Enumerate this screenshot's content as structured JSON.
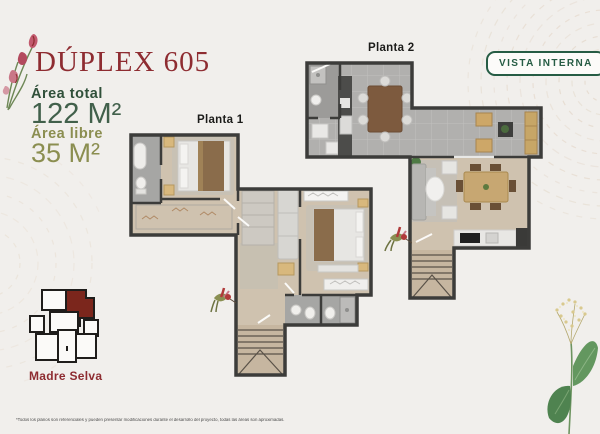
{
  "header": {
    "title": "DÚPLEX 605",
    "area_total_label": "Área total",
    "area_total_value": "122 M²",
    "area_libre_label": "Área libre",
    "area_libre_value": "35 M²"
  },
  "view_badge": {
    "label": "VISTA INTERNA"
  },
  "floorplans": {
    "planta1": {
      "label": "Planta 1"
    },
    "planta2": {
      "label": "Planta 2"
    }
  },
  "brand": {
    "name": "Madre Selva"
  },
  "footer": {
    "disclaimer": "*Todos los planos son referenciales y pueden presentar modificaciones durante el desarrollo del proyecto, todas las áreas son aproximadas."
  },
  "colors": {
    "background": "#f1efec",
    "title_red": "#8e2c31",
    "dark_green": "#30503a",
    "olive_green": "#8b8e50",
    "badge_green": "#265c44",
    "keyplan_unit_red": "#7b261c",
    "wall": "#3c3c3a",
    "wood_floor": "#cfc2af",
    "tile_floor": "#b1b0ae"
  }
}
